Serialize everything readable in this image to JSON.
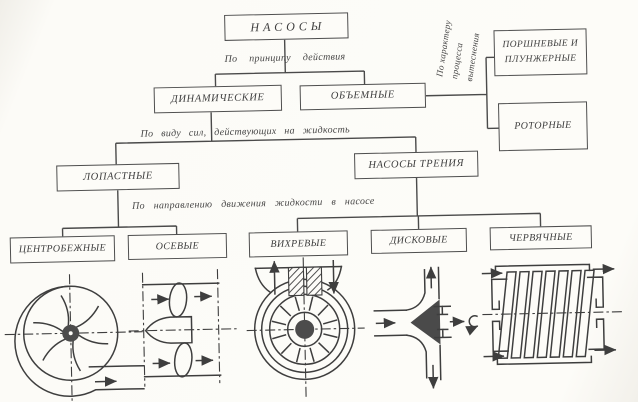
{
  "palette": {
    "paper": "#fdfcf8",
    "ink": "#3e3e3e"
  },
  "tree": {
    "root": "НАСОСЫ",
    "criteria": {
      "principle": "По принципу действия",
      "displacement": [
        "По характеру",
        "процесса",
        "вытеснения"
      ],
      "forces": "По виду сил, действующих на жидкость",
      "direction": "По направлению движения жидкости в насосе"
    },
    "dynamic": "ДИНАМИЧЕСКИЕ",
    "volumetric": "ОБЪЕМНЫЕ",
    "piston": "ПОРШНЕВЫЕ И ПЛУНЖЕРНЫЕ",
    "rotary": "РОТОРНЫЕ",
    "vane": "ЛОПАСТНЫЕ",
    "friction": "НАСОСЫ ТРЕНИЯ",
    "centrifugal": "ЦЕНТРОБЕЖНЫЕ",
    "axial": "ОСЕВЫЕ",
    "vortex": "ВИХРЕВЫЕ",
    "disk": "ДИСКОВЫЕ",
    "worm": "ЧЕРВЯЧНЫЕ"
  },
  "schematic_icons": [
    "centrifugal-pump-schematic",
    "axial-pump-schematic",
    "vortex-pump-schematic",
    "disk-pump-schematic",
    "worm-pump-schematic"
  ]
}
